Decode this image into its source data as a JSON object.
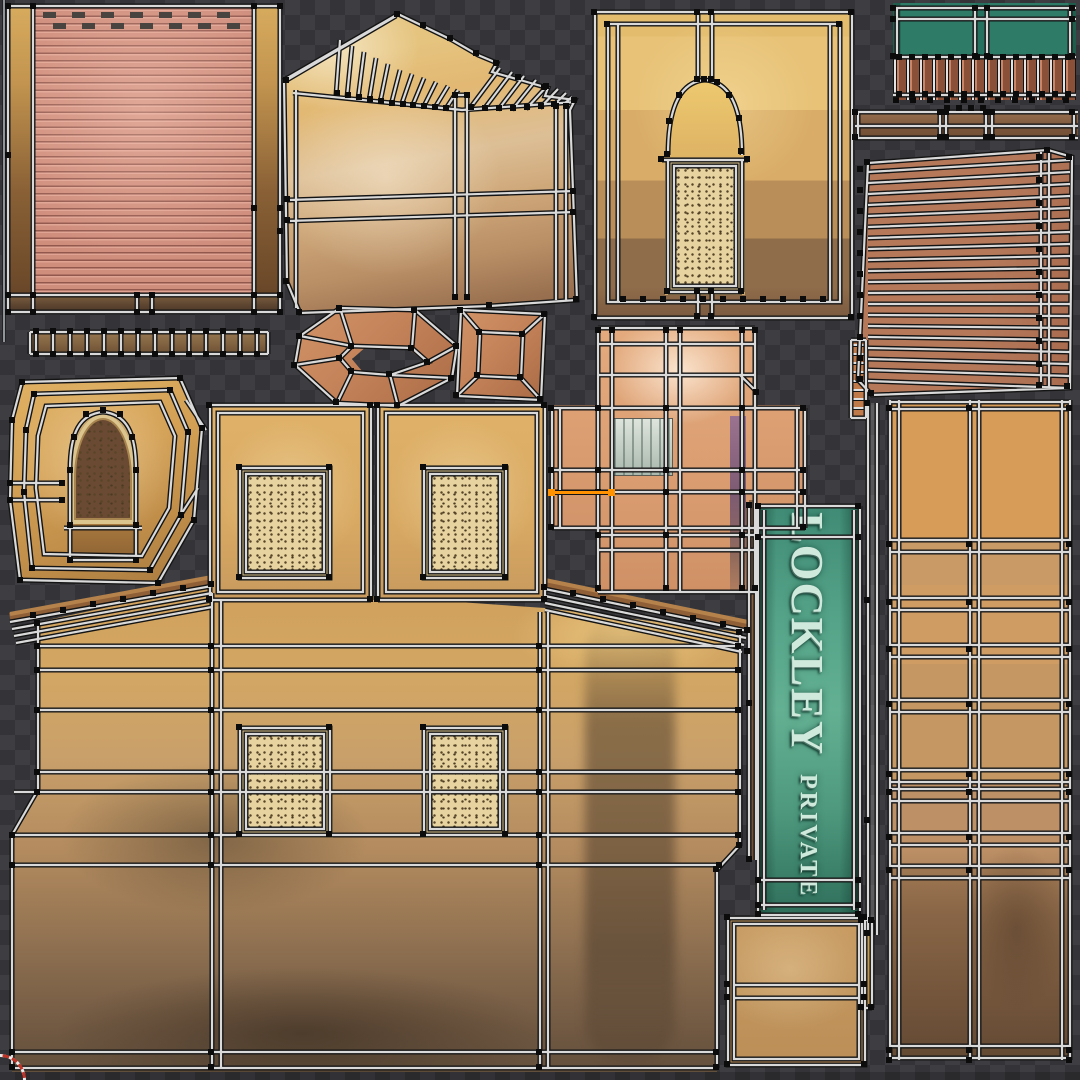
{
  "scene": {
    "type": "uv-texture-atlas",
    "description": "UV editor viewport: unwrapped building texture islands over transparency checkerboard"
  },
  "sign": {
    "line1": "LOCKLEY",
    "line2": "PRIVATE",
    "line3": "LTD."
  },
  "palette": {
    "checker_dark": "#343438",
    "checker_light": "#3e3e42",
    "wire": "#d9d9d9",
    "wire_outline": "#141414",
    "vertex": "#0c0c0c",
    "selected_edge": "#ff9200",
    "shutter_pink": "#cf8d7c",
    "plaster_gold": "#d7a75f",
    "plaster_brown": "#6e5742",
    "wood_brown": "#8f5f37",
    "box_orange": "#c5835a",
    "window_peach": "#dda174",
    "sign_teal": "#55a489",
    "railing_teal": "#2e7b68",
    "grille_cream": "#e6d3a0",
    "cursor_red": "#c03327"
  },
  "islands": [
    {
      "name": "roller-shutter",
      "color": "#cf8d7c"
    },
    {
      "name": "plank-ladder-strip",
      "color": "#8a6848"
    },
    {
      "name": "arch-plaque",
      "color": "#d3a055"
    },
    {
      "name": "gable-wall",
      "color": "#ddbf96"
    },
    {
      "name": "planter-box-ring",
      "color": "#c5835a"
    },
    {
      "name": "planter-box-square",
      "color": "#c5835a"
    },
    {
      "name": "arch-window-wall",
      "color": "#d9ad67"
    },
    {
      "name": "balcony-railing",
      "color": "#2e7b68"
    },
    {
      "name": "wood-beam-strip",
      "color": "#7a553a"
    },
    {
      "name": "shutter-slat-fan",
      "color": "#b5795a"
    },
    {
      "name": "window-frame-cross",
      "color": "#dda174"
    },
    {
      "name": "shop-sign",
      "color": "#55a489"
    },
    {
      "name": "side-column-wall",
      "color": "#c59763"
    },
    {
      "name": "main-facade-wall",
      "color": "#b28a5e"
    },
    {
      "name": "sign-back-box",
      "color": "#c89c63"
    }
  ],
  "editor": {
    "cursor_position": "bottom-left"
  }
}
